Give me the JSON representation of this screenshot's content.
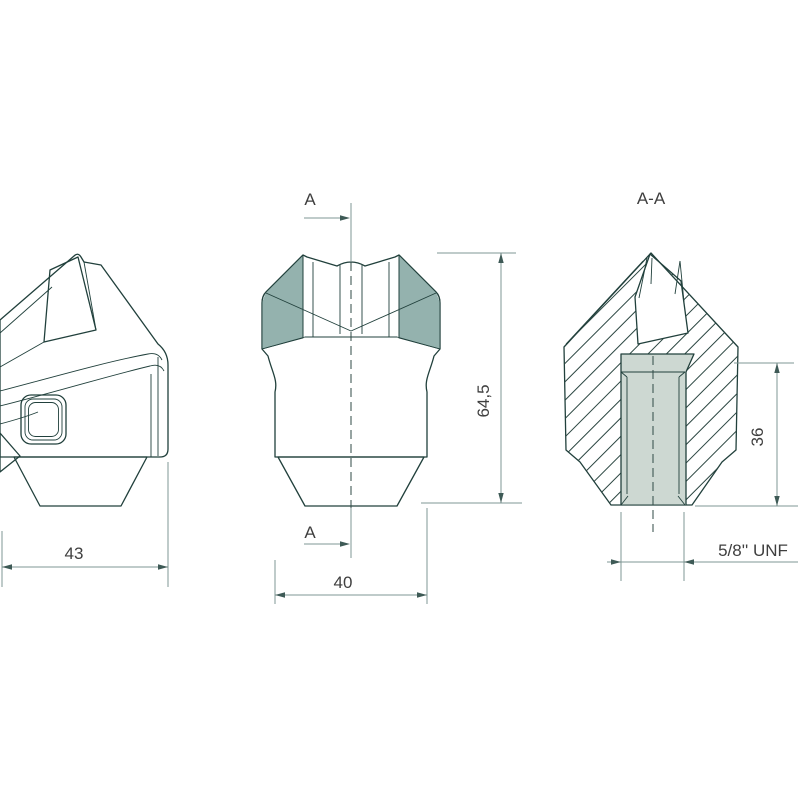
{
  "views": {
    "side": {
      "width_dim": "43"
    },
    "front": {
      "width_dim": "40",
      "height_dim": "64,5",
      "section_marker": "A"
    },
    "section": {
      "title": "A-A",
      "depth_dim": "36",
      "thread_label": "5/8'' UNF"
    }
  },
  "colors": {
    "body": "#87AAA6",
    "body_light": "#9EBBB7",
    "section_fill": "#C8D3CD",
    "hole_fill": "#CDD8D2",
    "outline": "#21403C",
    "dimension_line": "#7F9794",
    "text": "#3F3F3F",
    "background": "#FFFFFF"
  }
}
